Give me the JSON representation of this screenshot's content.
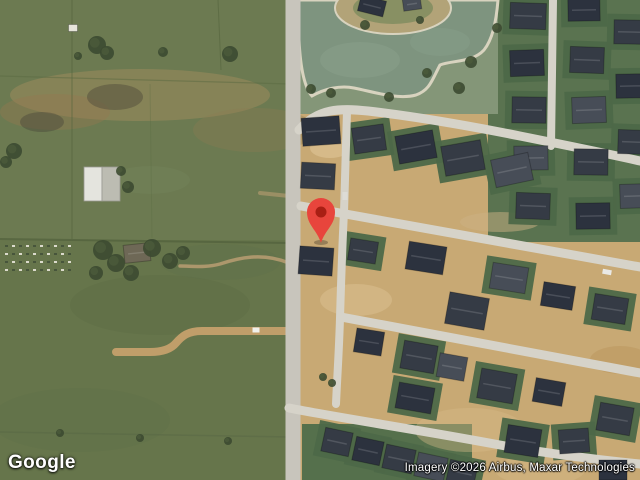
{
  "map": {
    "provider_logo": "Google",
    "attribution": "Imagery ©2026 Airbus, Maxar Technologies",
    "view_mode": "satellite",
    "marker": {
      "x": 321,
      "y": 243,
      "color": "#E8453C",
      "dot_color": "#A91F14"
    },
    "palette": {
      "farmland": "#6c7a51",
      "farmland_lower": "#647449",
      "dirt": "#c8a974",
      "lawn_lot": "#4d6848",
      "pond": "#7e947f",
      "shore": "#d8d3bf",
      "road": "#d6d3c9",
      "main_road": "#c8c5bc",
      "tree": "#3c4a31",
      "roof_shades": [
        "#353b45",
        "#2c323e",
        "#474d57",
        "#6e6856",
        "#e6e4da"
      ]
    },
    "features": {
      "dev_area": [
        300,
        0,
        340,
        480
      ],
      "lower_field": [
        0,
        240,
        300,
        240
      ],
      "lawn_zones": [
        [
          488,
          0,
          152,
          242,
          "#5a7350"
        ],
        [
          300,
          0,
          198,
          114,
          "#849678"
        ],
        [
          302,
          424,
          170,
          56,
          "#55704c"
        ]
      ],
      "patches": [
        [
          140,
          95,
          130,
          26,
          "#a78d60",
          0.45
        ],
        [
          55,
          112,
          55,
          18,
          "#97794f",
          0.4
        ],
        [
          255,
          130,
          62,
          22,
          "#8d7a52",
          0.35
        ],
        [
          115,
          97,
          28,
          13,
          "#514d3c",
          0.5
        ],
        [
          42,
          122,
          22,
          10,
          "#4a463a",
          0.45
        ],
        [
          160,
          305,
          90,
          30,
          "#5d6d45",
          0.5
        ],
        [
          80,
          420,
          90,
          32,
          "#5f704a",
          0.45
        ],
        [
          220,
          262,
          60,
          18,
          "#60714b",
          0.4
        ],
        [
          150,
          180,
          40,
          14,
          "#72815a",
          0.5
        ],
        [
          330,
          148,
          20,
          10,
          "#e3cb9e",
          0.5
        ],
        [
          356,
          300,
          36,
          16,
          "#dcc291",
          0.5
        ],
        [
          470,
          430,
          55,
          22,
          "#d6bc8a",
          0.4
        ],
        [
          540,
          470,
          45,
          15,
          "#d6bc8a",
          0.4
        ],
        [
          620,
          360,
          30,
          14,
          "#b79258",
          0.4
        ],
        [
          500,
          222,
          40,
          10,
          "#cbb183",
          0.5
        ]
      ],
      "fences": [
        [
          "M72,0 L72,239",
          1,
          "#55643e",
          0.65
        ],
        [
          "M218,0 L221,70",
          1,
          "#55643e",
          0.6
        ],
        [
          "M0,76 L290,84",
          1.2,
          "#5a6942",
          0.5
        ],
        [
          "M0,239 L292,243",
          2,
          "#4c5c39",
          0.6
        ],
        [
          "M0,432 L290,437",
          1.5,
          "#556544",
          0.4
        ],
        [
          "M150,84 L152,238",
          1,
          "#5a6942",
          0.3
        ]
      ],
      "garden_plot": {
        "x": 2,
        "y": 242,
        "w": 72,
        "h": 28
      },
      "pond_path": "M299,0 L498,0 C496,24 492,40 484,50 C472,63 452,60 440,65 C432,80 430,90 416,95 C398,100 374,92 354,88 C340,85 324,89 312,96 C303,86 300,60 299,40 Z",
      "pond_swirls": [
        [
          360,
          60,
          40,
          18,
          "#8aa08c",
          0.5
        ],
        [
          440,
          42,
          30,
          14,
          "#8aa08c",
          0.4
        ]
      ],
      "island": {
        "x": 393,
        "y": 8,
        "rx": 58,
        "ry": 26,
        "c": "#b2a378",
        "inner_c": "#7d8b5e"
      },
      "roads": [
        {
          "d": "M290,331 L202,331 C188,331 182,336 176,343 C171,349 162,352 150,352 L116,352",
          "w": 8,
          "c": "#c09e6a",
          "o": 1
        },
        {
          "d": "M289,263 C262,252 238,258 220,264 C206,268 192,266 180,266",
          "w": 3.5,
          "c": "#b99d72",
          "o": 0.85
        },
        {
          "d": "M289,196 L260,193",
          "w": 4,
          "c": "#b99d72",
          "o": 0.6
        },
        {
          "d": "M293,0 L293,480",
          "w": 15,
          "c": "#c8c5bc",
          "o": 1
        },
        {
          "d": "M299,130 C318,108 340,108 368,111 C420,117 470,126 520,136 C560,144 600,152 640,161",
          "w": 9,
          "c": "#d6d3c9",
          "o": 1
        },
        {
          "d": "M553,0 L551,146",
          "w": 8,
          "c": "#d6d3c9",
          "o": 1
        },
        {
          "d": "M347,111 C346,150 345,180 344,212 C342,250 341,285 340,318 C339,352 337,380 336,404",
          "w": 8,
          "c": "#d6d3c9",
          "o": 1
        },
        {
          "d": "M301,206 L640,267",
          "w": 9,
          "c": "#d6d3c9",
          "o": 1
        },
        {
          "d": "M341,317 L640,373",
          "w": 9,
          "c": "#d6d3c9",
          "o": 1
        },
        {
          "d": "M289,408 C340,418 420,430 500,445 C550,454 600,460 640,464",
          "w": 9,
          "c": "#d6d3c9",
          "o": 1
        }
      ],
      "barn": {
        "x": 84,
        "y": 167,
        "w": 36,
        "h": 34
      },
      "houses": [
        [
          528,
          16,
          36,
          26,
          2,
          0,
          1
        ],
        [
          527,
          63,
          34,
          26,
          -2,
          1,
          1
        ],
        [
          529,
          110,
          34,
          26,
          1,
          0,
          1
        ],
        [
          531,
          158,
          34,
          24,
          -1,
          2,
          1
        ],
        [
          533,
          206,
          34,
          26,
          2,
          0,
          1
        ],
        [
          584,
          10,
          32,
          22,
          -1,
          1,
          1
        ],
        [
          587,
          60,
          34,
          26,
          2,
          0,
          1
        ],
        [
          589,
          110,
          34,
          26,
          -2,
          2,
          1
        ],
        [
          591,
          162,
          34,
          26,
          1,
          0,
          1
        ],
        [
          593,
          216,
          34,
          26,
          -1,
          1,
          1
        ],
        [
          629,
          32,
          30,
          24,
          1,
          0,
          1
        ],
        [
          631,
          86,
          30,
          24,
          -1,
          1,
          1
        ],
        [
          633,
          142,
          30,
          24,
          2,
          0,
          1
        ],
        [
          635,
          196,
          30,
          24,
          -2,
          2,
          1
        ],
        [
          321,
          131,
          38,
          28,
          -4,
          1,
          0
        ],
        [
          318,
          176,
          34,
          26,
          3,
          0,
          0
        ],
        [
          369,
          139,
          32,
          26,
          -8,
          0,
          1
        ],
        [
          416,
          147,
          38,
          28,
          -10,
          1,
          1
        ],
        [
          463,
          158,
          40,
          30,
          -10,
          0,
          1
        ],
        [
          512,
          170,
          38,
          28,
          -12,
          2,
          1
        ],
        [
          316,
          261,
          34,
          28,
          4,
          1,
          0
        ],
        [
          363,
          251,
          28,
          22,
          9,
          0,
          1
        ],
        [
          426,
          258,
          38,
          28,
          9,
          1,
          0
        ],
        [
          467,
          311,
          40,
          32,
          10,
          0,
          0
        ],
        [
          509,
          278,
          36,
          26,
          9,
          2,
          1
        ],
        [
          558,
          296,
          32,
          24,
          9,
          1,
          0
        ],
        [
          610,
          309,
          34,
          26,
          9,
          0,
          1
        ],
        [
          369,
          342,
          28,
          24,
          9,
          1,
          0
        ],
        [
          419,
          357,
          34,
          28,
          10,
          0,
          1
        ],
        [
          452,
          367,
          28,
          24,
          10,
          2,
          0
        ],
        [
          497,
          386,
          36,
          30,
          10,
          0,
          1
        ],
        [
          549,
          392,
          30,
          24,
          10,
          1,
          0
        ],
        [
          615,
          419,
          34,
          28,
          10,
          0,
          1
        ],
        [
          415,
          398,
          36,
          26,
          10,
          1,
          1
        ],
        [
          337,
          442,
          28,
          24,
          12,
          0,
          1
        ],
        [
          368,
          451,
          28,
          24,
          12,
          1,
          1
        ],
        [
          399,
          459,
          30,
          24,
          12,
          0,
          1
        ],
        [
          431,
          467,
          30,
          24,
          12,
          2,
          1
        ],
        [
          462,
          473,
          28,
          22,
          12,
          0,
          1
        ],
        [
          523,
          441,
          34,
          28,
          9,
          1,
          1
        ],
        [
          574,
          441,
          30,
          24,
          -4,
          0,
          1
        ],
        [
          613,
          470,
          28,
          20,
          0,
          1,
          0
        ],
        [
          372,
          6,
          26,
          16,
          14,
          1,
          0
        ],
        [
          412,
          4,
          18,
          12,
          -8,
          2,
          0
        ],
        [
          137,
          253,
          26,
          18,
          -6,
          3,
          0
        ],
        [
          73,
          28,
          9,
          7,
          0,
          4,
          0
        ]
      ],
      "trees": [
        [
          97,
          45,
          9
        ],
        [
          107,
          53,
          7
        ],
        [
          230,
          54,
          8
        ],
        [
          163,
          52,
          5
        ],
        [
          78,
          56,
          4
        ],
        [
          14,
          151,
          8
        ],
        [
          6,
          162,
          6
        ],
        [
          121,
          171,
          5
        ],
        [
          128,
          187,
          6
        ],
        [
          103,
          250,
          10
        ],
        [
          116,
          263,
          9
        ],
        [
          131,
          273,
          8
        ],
        [
          152,
          248,
          9
        ],
        [
          170,
          261,
          8
        ],
        [
          183,
          253,
          7
        ],
        [
          96,
          273,
          7
        ],
        [
          60,
          433,
          4
        ],
        [
          140,
          438,
          4
        ],
        [
          228,
          441,
          4
        ],
        [
          311,
          89,
          5
        ],
        [
          331,
          93,
          5
        ],
        [
          389,
          97,
          5
        ],
        [
          427,
          73,
          5
        ],
        [
          459,
          88,
          6
        ],
        [
          471,
          62,
          6
        ],
        [
          323,
          377,
          4
        ],
        [
          332,
          383,
          4
        ],
        [
          497,
          28,
          5
        ],
        [
          365,
          25,
          5
        ],
        [
          420,
          20,
          4
        ]
      ],
      "cars": [
        [
          607,
          272,
          9,
          5,
          10,
          "#e9e9e6"
        ],
        [
          345,
          196,
          5,
          8,
          0,
          "#dddcd6"
        ],
        [
          256,
          330,
          7,
          5,
          0,
          "#f0f0ec"
        ]
      ]
    }
  }
}
